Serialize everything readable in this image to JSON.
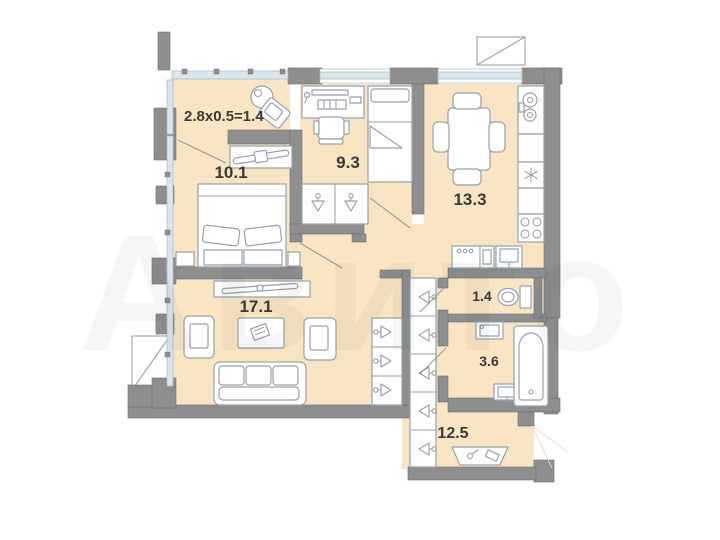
{
  "plan": {
    "type": "apartment-floor-plan",
    "rooms": [
      {
        "name": "balcony",
        "label": "2.8x0.5=1.4"
      },
      {
        "name": "bedroom",
        "label": "10.1"
      },
      {
        "name": "room",
        "label": "9.3"
      },
      {
        "name": "kitchen",
        "label": "13.3"
      },
      {
        "name": "living-room",
        "label": "17.1"
      },
      {
        "name": "wc",
        "label": "1.4"
      },
      {
        "name": "bathroom",
        "label": "3.6"
      },
      {
        "name": "hallway",
        "label": "12.5"
      }
    ],
    "watermark": "Авито",
    "colors": {
      "background": "#ffffff",
      "floor": "#f9e5c4",
      "walls": "#8e8e8e",
      "windows": "#d9e6ed",
      "furniture_stroke": "#98a1a8",
      "label_text": "#3a3a3a"
    }
  }
}
